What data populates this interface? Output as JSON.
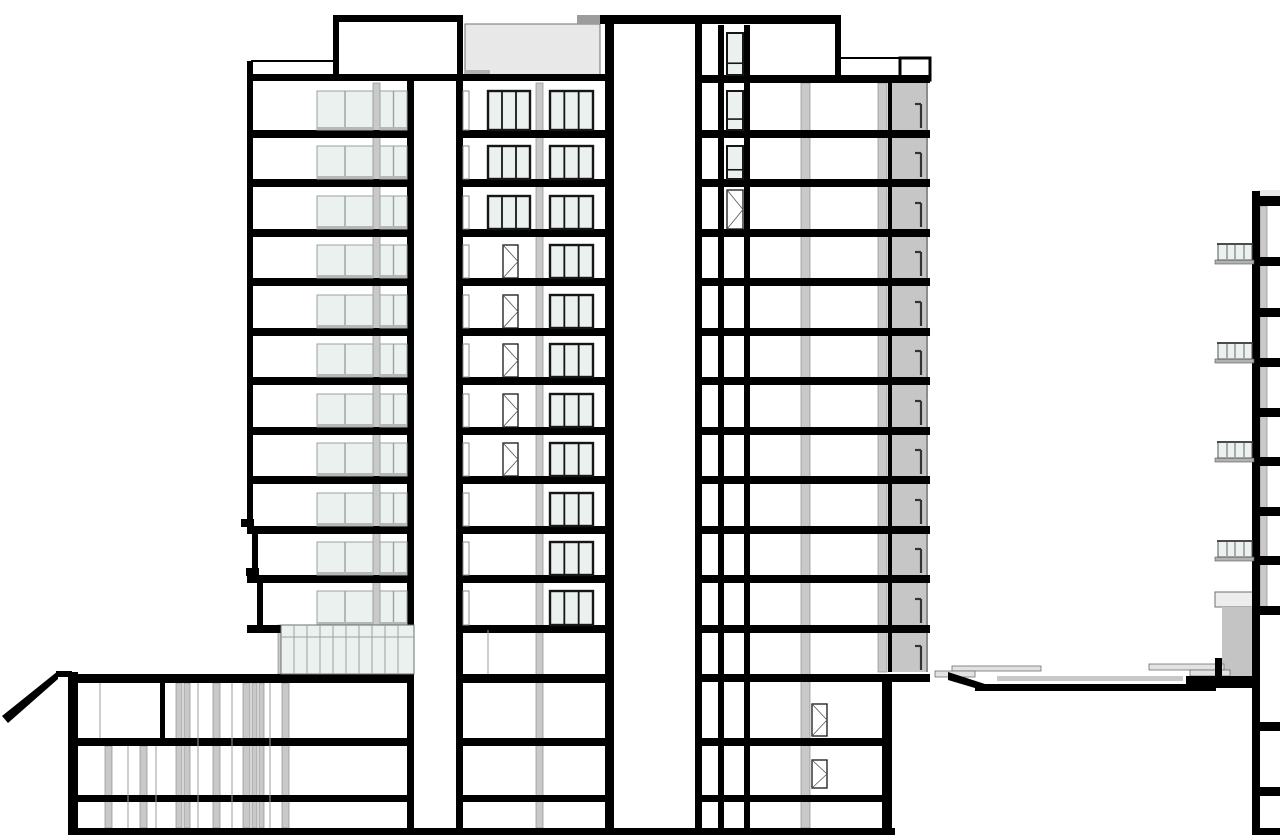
{
  "drawing": {
    "canvas": {
      "width": 1280,
      "height": 835,
      "background": "#ffffff"
    },
    "colors": {
      "black": "#000000",
      "white": "#ffffff",
      "glass": "#eaf1ef",
      "frameLite": "#9aa3a1",
      "frameDark": "#161616",
      "gray": "#c9c9c9",
      "grayEdge": "#8c8c8c",
      "band": "#c6c6c6",
      "deckTop": "#e8e8e8",
      "deckTab": "#9c9c9c",
      "deckStep": "#b2b2b2",
      "plaza": "#c8c8c8",
      "planter": "#e2e2e2",
      "canopy": "#ededed",
      "volume": "#c4c4c4",
      "sill": "#b7b7b7",
      "thin": "#6f6f6f",
      "lineGray": "#9e9e9e",
      "doorLine": "#555555",
      "tick": "#333333"
    },
    "gray_rects": [
      [
        373,
        83,
        7,
        542
      ],
      [
        536,
        83,
        7,
        745
      ],
      [
        801,
        83,
        9,
        745
      ],
      [
        878,
        83,
        9,
        589
      ],
      [
        1260,
        206,
        7,
        401
      ],
      [
        105,
        746,
        7,
        82
      ],
      [
        140,
        746,
        7,
        82
      ],
      [
        176,
        683,
        6,
        145
      ],
      [
        184,
        683,
        6,
        145
      ],
      [
        213,
        683,
        7,
        145
      ],
      [
        243,
        683,
        7,
        145
      ],
      [
        252,
        683,
        5,
        145
      ],
      [
        259,
        683,
        5,
        145
      ],
      [
        282,
        683,
        7,
        145
      ],
      [
        278,
        625,
        8,
        49
      ],
      [
        383,
        625,
        7,
        49
      ]
    ],
    "special_rects": [
      [
        892,
        83,
        35,
        589,
        "band",
        null,
        0
      ],
      [
        926,
        83,
        2,
        589,
        "grayEdge",
        null,
        0
      ],
      [
        465,
        24,
        135,
        53,
        "deckTop",
        "thin",
        1
      ],
      [
        577,
        15,
        26,
        9,
        "deckTab",
        null,
        0
      ],
      [
        465,
        70,
        25,
        7,
        "deckStep",
        null,
        0
      ],
      [
        1258,
        190,
        22,
        6,
        "deckTop",
        null,
        0
      ],
      [
        1215,
        592,
        38,
        15,
        "canopy",
        "thin",
        1
      ],
      [
        1222,
        607,
        31,
        70,
        "volume",
        null,
        0
      ],
      [
        997,
        676,
        186,
        5,
        "plaza",
        null,
        0
      ],
      [
        1190,
        669,
        26,
        4,
        "deckStep",
        null,
        0
      ],
      [
        952,
        666,
        89,
        5,
        "planter",
        "thin",
        0.8
      ],
      [
        935,
        671,
        40,
        6,
        "planter",
        "thin",
        0.8
      ],
      [
        1149,
        664,
        75,
        6,
        "planter",
        "thin",
        0.8
      ],
      [
        1190,
        670,
        40,
        6,
        "planter",
        "thin",
        0.8
      ],
      [
        900,
        58,
        30,
        22,
        "white",
        "black",
        3
      ]
    ],
    "black_rects": [
      [
        251,
        74,
        362,
        7
      ],
      [
        600,
        15,
        241,
        9
      ],
      [
        333,
        15,
        130,
        7
      ],
      [
        695,
        75,
        235,
        8
      ],
      [
        247,
        130,
        167,
        8
      ],
      [
        247,
        179,
        167,
        8
      ],
      [
        247,
        229,
        167,
        8
      ],
      [
        247,
        278,
        167,
        8
      ],
      [
        247,
        328,
        167,
        8
      ],
      [
        247,
        377,
        167,
        8
      ],
      [
        247,
        427,
        167,
        8
      ],
      [
        247,
        476,
        167,
        8
      ],
      [
        247,
        526,
        167,
        8
      ],
      [
        247,
        575,
        167,
        8
      ],
      [
        247,
        625,
        167,
        8
      ],
      [
        456,
        130,
        157,
        8
      ],
      [
        456,
        179,
        157,
        8
      ],
      [
        456,
        229,
        157,
        8
      ],
      [
        456,
        278,
        157,
        8
      ],
      [
        456,
        328,
        157,
        8
      ],
      [
        456,
        377,
        157,
        8
      ],
      [
        456,
        427,
        157,
        8
      ],
      [
        456,
        476,
        157,
        8
      ],
      [
        456,
        526,
        157,
        8
      ],
      [
        456,
        575,
        157,
        8
      ],
      [
        456,
        625,
        157,
        8
      ],
      [
        695,
        130,
        235,
        8
      ],
      [
        695,
        179,
        235,
        8
      ],
      [
        695,
        229,
        235,
        8
      ],
      [
        695,
        278,
        235,
        8
      ],
      [
        695,
        328,
        235,
        8
      ],
      [
        695,
        377,
        235,
        8
      ],
      [
        695,
        427,
        235,
        8
      ],
      [
        695,
        476,
        235,
        8
      ],
      [
        695,
        526,
        235,
        8
      ],
      [
        695,
        575,
        235,
        8
      ],
      [
        695,
        625,
        235,
        8
      ],
      [
        68,
        674,
        346,
        9
      ],
      [
        456,
        674,
        157,
        9
      ],
      [
        695,
        674,
        235,
        8
      ],
      [
        68,
        738,
        346,
        8
      ],
      [
        456,
        738,
        157,
        8
      ],
      [
        695,
        738,
        197,
        8
      ],
      [
        68,
        795,
        346,
        7
      ],
      [
        456,
        795,
        157,
        7
      ],
      [
        695,
        795,
        197,
        7
      ],
      [
        68,
        828,
        827,
        7
      ],
      [
        1253,
        828,
        27,
        7
      ],
      [
        241,
        519,
        13,
        8
      ],
      [
        246,
        568,
        13,
        8
      ],
      [
        1252,
        196,
        28,
        10
      ],
      [
        1260,
        257,
        20,
        9
      ],
      [
        1260,
        308,
        20,
        9
      ],
      [
        1260,
        358,
        20,
        9
      ],
      [
        1260,
        408,
        20,
        9
      ],
      [
        1260,
        457,
        20,
        9
      ],
      [
        1260,
        507,
        20,
        9
      ],
      [
        1260,
        556,
        20,
        9
      ],
      [
        1260,
        606,
        20,
        9
      ],
      [
        1260,
        722,
        20,
        9
      ],
      [
        1260,
        787,
        20,
        9
      ],
      [
        1186,
        676,
        74,
        12
      ],
      [
        975,
        684,
        241,
        7
      ],
      [
        56,
        671,
        16,
        6
      ],
      [
        247,
        61,
        6,
        465
      ],
      [
        252,
        526,
        6,
        49
      ],
      [
        257,
        575,
        6,
        50
      ],
      [
        407,
        81,
        7,
        747
      ],
      [
        456,
        81,
        7,
        747
      ],
      [
        333,
        15,
        6,
        60
      ],
      [
        457,
        15,
        6,
        66
      ],
      [
        605,
        15,
        9,
        820
      ],
      [
        695,
        15,
        7,
        820
      ],
      [
        718,
        25,
        6,
        803
      ],
      [
        744,
        25,
        6,
        803
      ],
      [
        835,
        15,
        6,
        68
      ],
      [
        882,
        674,
        10,
        161
      ],
      [
        68,
        672,
        10,
        163
      ],
      [
        1252,
        191,
        8,
        644
      ],
      [
        1215,
        658,
        7,
        30
      ],
      [
        888,
        83,
        4,
        589
      ],
      [
        160,
        683,
        5,
        55
      ]
    ],
    "polys": [
      [
        [
          2,
          716
        ],
        [
          58,
          671
        ],
        [
          58,
          679
        ],
        [
          8,
          723
        ]
      ],
      [
        [
          948,
          672
        ],
        [
          985,
          684
        ],
        [
          985,
          691
        ],
        [
          948,
          680
        ]
      ]
    ],
    "lines": [
      [
        251,
        61,
        333,
        61,
        2,
        "black"
      ],
      [
        841,
        58,
        900,
        58,
        2,
        "black"
      ],
      [
        281,
        637,
        414,
        637,
        1,
        "frameLite"
      ],
      [
        100,
        683,
        100,
        738,
        1,
        "lineGray"
      ],
      [
        128,
        746,
        128,
        828,
        1,
        "lineGray"
      ],
      [
        156,
        746,
        156,
        828,
        1,
        "lineGray"
      ],
      [
        198,
        683,
        198,
        828,
        1,
        "lineGray"
      ],
      [
        232,
        683,
        232,
        828,
        1,
        "lineGray"
      ],
      [
        270,
        683,
        270,
        828,
        1,
        "lineGray"
      ],
      [
        488,
        630,
        488,
        674,
        1,
        "lineGray"
      ]
    ],
    "windows": [
      [
        317,
        91,
        56,
        39,
        "tint"
      ],
      [
        317,
        146,
        56,
        33,
        "tint"
      ],
      [
        317,
        196,
        56,
        33,
        "tint"
      ],
      [
        317,
        245,
        56,
        33,
        "tint"
      ],
      [
        317,
        295,
        56,
        33,
        "tint"
      ],
      [
        317,
        344,
        56,
        33,
        "tint"
      ],
      [
        317,
        394,
        56,
        33,
        "tint"
      ],
      [
        317,
        443,
        56,
        33,
        "tint"
      ],
      [
        317,
        493,
        56,
        33,
        "tint"
      ],
      [
        317,
        542,
        56,
        33,
        "tint"
      ],
      [
        317,
        591,
        56,
        34,
        "tint"
      ],
      [
        380,
        91,
        27,
        39,
        "tint2"
      ],
      [
        380,
        146,
        27,
        33,
        "tint2"
      ],
      [
        380,
        196,
        27,
        33,
        "tint2"
      ],
      [
        380,
        245,
        27,
        33,
        "tint2"
      ],
      [
        380,
        295,
        27,
        33,
        "tint2"
      ],
      [
        380,
        344,
        27,
        33,
        "tint2"
      ],
      [
        380,
        394,
        27,
        33,
        "tint2"
      ],
      [
        380,
        443,
        27,
        33,
        "tint2"
      ],
      [
        380,
        493,
        27,
        33,
        "tint2"
      ],
      [
        380,
        542,
        27,
        33,
        "tint2"
      ],
      [
        380,
        591,
        27,
        34,
        "tint2"
      ],
      [
        488,
        91,
        42,
        39,
        "dark"
      ],
      [
        488,
        146,
        42,
        33,
        "dark"
      ],
      [
        488,
        196,
        42,
        33,
        "dark"
      ],
      [
        503,
        245,
        15,
        33,
        "door"
      ],
      [
        503,
        295,
        15,
        33,
        "door"
      ],
      [
        503,
        344,
        15,
        33,
        "door"
      ],
      [
        503,
        394,
        15,
        33,
        "door"
      ],
      [
        503,
        443,
        15,
        33,
        "door"
      ],
      [
        550,
        91,
        43,
        39,
        "dark"
      ],
      [
        550,
        146,
        43,
        33,
        "dark"
      ],
      [
        550,
        196,
        43,
        33,
        "dark"
      ],
      [
        550,
        245,
        43,
        33,
        "dark"
      ],
      [
        550,
        295,
        43,
        33,
        "dark"
      ],
      [
        550,
        344,
        43,
        33,
        "dark"
      ],
      [
        550,
        394,
        43,
        33,
        "dark"
      ],
      [
        550,
        443,
        43,
        33,
        "dark"
      ],
      [
        550,
        493,
        43,
        33,
        "dark"
      ],
      [
        550,
        542,
        43,
        33,
        "dark"
      ],
      [
        550,
        591,
        43,
        34,
        "dark"
      ],
      [
        463,
        91,
        6,
        39,
        "slit"
      ],
      [
        463,
        146,
        6,
        33,
        "slit"
      ],
      [
        463,
        196,
        6,
        33,
        "slit"
      ],
      [
        463,
        245,
        6,
        33,
        "slit"
      ],
      [
        463,
        295,
        6,
        33,
        "slit"
      ],
      [
        463,
        344,
        6,
        33,
        "slit"
      ],
      [
        463,
        394,
        6,
        33,
        "slit"
      ],
      [
        463,
        443,
        6,
        33,
        "slit"
      ],
      [
        463,
        493,
        6,
        33,
        "slit"
      ],
      [
        463,
        542,
        6,
        33,
        "slit"
      ],
      [
        463,
        591,
        6,
        34,
        "slit"
      ],
      [
        727,
        33,
        16,
        42,
        "small"
      ],
      [
        727,
        91,
        16,
        39,
        "small"
      ],
      [
        727,
        146,
        16,
        33,
        "small"
      ],
      [
        727,
        190,
        16,
        39,
        "door"
      ],
      [
        812,
        704,
        15,
        32,
        "door"
      ],
      [
        812,
        760,
        15,
        28,
        "door"
      ],
      [
        281,
        625,
        133,
        49,
        "store"
      ]
    ],
    "balconies": {
      "x": 1218,
      "w": 34,
      "rail_h": 16,
      "ys": [
        244,
        343,
        442,
        541
      ]
    },
    "ticks": {
      "x": 921,
      "h": 26,
      "bottoms": [
        130,
        179,
        229,
        278,
        328,
        377,
        427,
        476,
        526,
        575,
        625,
        672
      ]
    }
  }
}
